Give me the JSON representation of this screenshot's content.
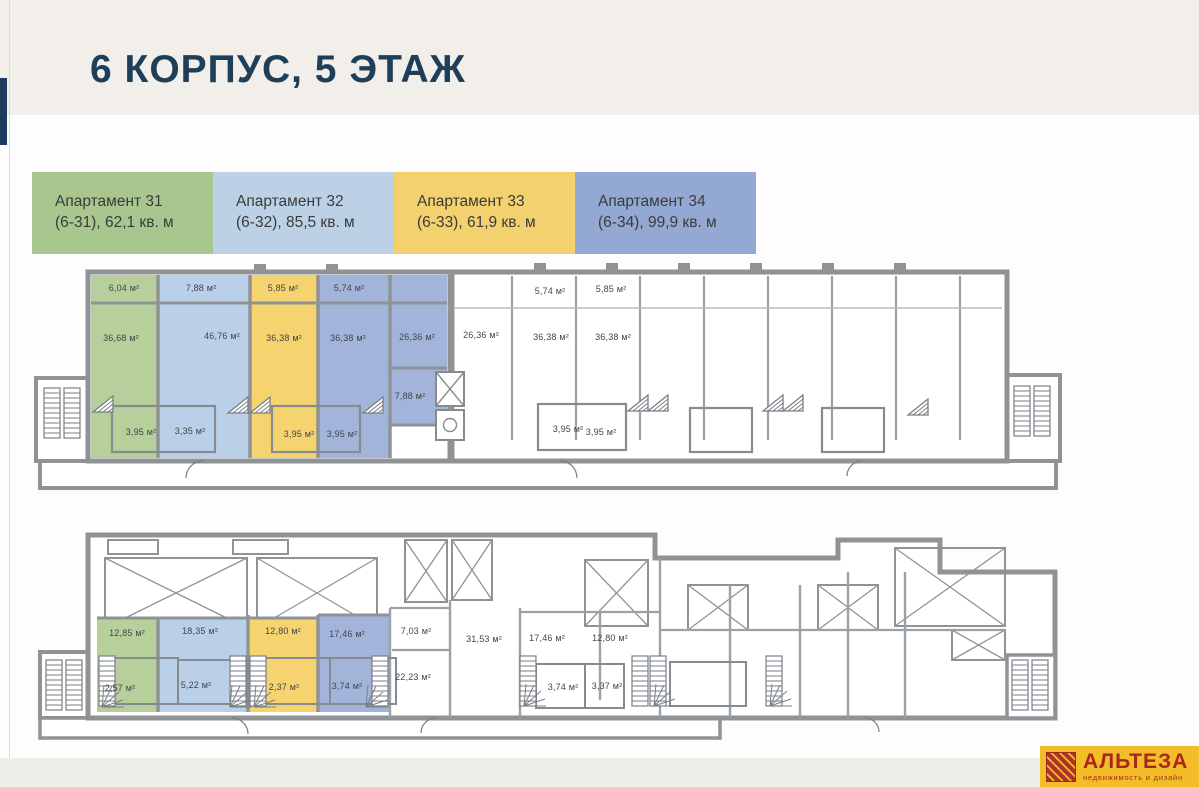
{
  "page": {
    "title": "6 КОРПУС, 5 ЭТАЖ"
  },
  "legend": {
    "items": [
      {
        "line1": "Апартамент 31",
        "line2": "(6-31), 62,1 кв. м",
        "color": "#a9c68e"
      },
      {
        "line1": "Апартамент 32",
        "line2": "(6-32), 85,5 кв. м",
        "color": "#bcd1e6"
      },
      {
        "line1": "Апартамент 33",
        "line2": "(6-33), 61,9 кв. м",
        "color": "#f3d16e"
      },
      {
        "line1": "Апартамент 34",
        "line2": "(6-34), 99,9 кв. м",
        "color": "#93a8d3"
      }
    ]
  },
  "plan_colors": {
    "apartment31": "#b7cf9a",
    "apartment32": "#b9d0e8",
    "apartment33": "#f5d36e",
    "apartment34": "#a3b4da",
    "walls": "#8f9396"
  },
  "plans": {
    "upper": {
      "name": "Верхний уровень",
      "labels": [
        {
          "text": "6,04 м²",
          "x": 124,
          "y": 288
        },
        {
          "text": "7,88 м²",
          "x": 201,
          "y": 288
        },
        {
          "text": "5,85 м²",
          "x": 283,
          "y": 288
        },
        {
          "text": "5,74 м²",
          "x": 349,
          "y": 288
        },
        {
          "text": "36,68 м²",
          "x": 121,
          "y": 338
        },
        {
          "text": "46,76 м²",
          "x": 222,
          "y": 336
        },
        {
          "text": "36,38 м²",
          "x": 284,
          "y": 338
        },
        {
          "text": "36,38 м²",
          "x": 348,
          "y": 338
        },
        {
          "text": "26,36 м²",
          "x": 417,
          "y": 337
        },
        {
          "text": "26,36 м²",
          "x": 481,
          "y": 335
        },
        {
          "text": "5,74 м²",
          "x": 550,
          "y": 291
        },
        {
          "text": "5,85 м²",
          "x": 611,
          "y": 289
        },
        {
          "text": "36,38 м²",
          "x": 551,
          "y": 337
        },
        {
          "text": "36,38 м²",
          "x": 613,
          "y": 337
        },
        {
          "text": "7,88 м²",
          "x": 410,
          "y": 396
        },
        {
          "text": "3,95 м²",
          "x": 141,
          "y": 432
        },
        {
          "text": "3,35 м²",
          "x": 190,
          "y": 431
        },
        {
          "text": "3,95 м²",
          "x": 299,
          "y": 434
        },
        {
          "text": "3,95 м²",
          "x": 342,
          "y": 434
        },
        {
          "text": "3,95 м²",
          "x": 568,
          "y": 429
        },
        {
          "text": "3,95 м²",
          "x": 601,
          "y": 432
        }
      ]
    },
    "lower": {
      "name": "Нижний уровень",
      "labels": [
        {
          "text": "12,85 м²",
          "x": 127,
          "y": 633
        },
        {
          "text": "18,35 м²",
          "x": 200,
          "y": 631
        },
        {
          "text": "12,80 м²",
          "x": 283,
          "y": 631
        },
        {
          "text": "17,46 м²",
          "x": 347,
          "y": 634
        },
        {
          "text": "7,03 м²",
          "x": 416,
          "y": 631
        },
        {
          "text": "22,23 м²",
          "x": 413,
          "y": 677
        },
        {
          "text": "31,53 м²",
          "x": 484,
          "y": 639
        },
        {
          "text": "17,46 м²",
          "x": 547,
          "y": 638
        },
        {
          "text": "12,80 м²",
          "x": 610,
          "y": 638
        },
        {
          "text": "2,57 м²",
          "x": 120,
          "y": 688
        },
        {
          "text": "5,22 м²",
          "x": 196,
          "y": 685
        },
        {
          "text": "2,37 м²",
          "x": 284,
          "y": 687
        },
        {
          "text": "3,74 м²",
          "x": 347,
          "y": 686
        },
        {
          "text": "3,74 м²",
          "x": 563,
          "y": 687
        },
        {
          "text": "3,37 м²",
          "x": 607,
          "y": 686
        }
      ]
    }
  },
  "logo": {
    "brand": "АЛЬТЕЗА",
    "tagline": "недвижимость и дизайн",
    "background": "#f3bd29",
    "foreground": "#a8281c"
  }
}
